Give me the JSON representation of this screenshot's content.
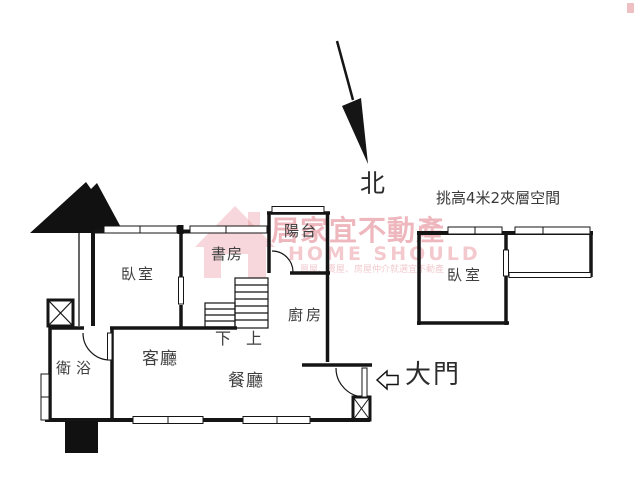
{
  "compass": {
    "label": "北"
  },
  "mezzanine": {
    "note": "挑高4米2夾層空間",
    "bedroom": "臥室"
  },
  "rooms": {
    "bedroom": "臥室",
    "study": "書房",
    "balcony": "陽台",
    "kitchen": "廚房",
    "living": "客廳",
    "dining": "餐廳",
    "bathroom": "衛浴"
  },
  "stairs": {
    "down": "下",
    "up": "上"
  },
  "entrance": {
    "label": "大門"
  },
  "watermark": {
    "brand_zh": "居家宜不動產",
    "brand_en": "HOME SHOULD",
    "tagline": "買屋、賣屋、房屋仲介就選宜不動產",
    "logo": "house-icon"
  },
  "colors": {
    "line": "#151515",
    "label": "#3f3f3f",
    "watermark": "#de707c"
  }
}
